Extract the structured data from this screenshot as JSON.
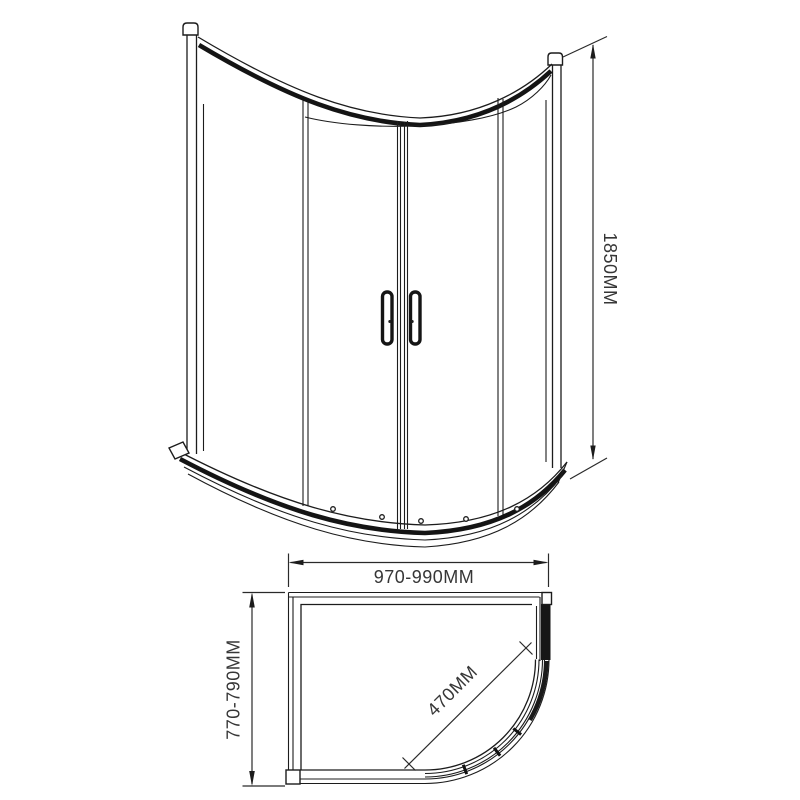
{
  "colors": {
    "background": "#ffffff",
    "line": "#1c1c1c",
    "dimension_text": "#363636",
    "profile_fill": "#161616"
  },
  "views": {
    "front_elevation": {
      "height_dimension_label": "1850MM"
    },
    "plan": {
      "width_dimension_label": "970-990MM",
      "depth_dimension_label": "770-790MM",
      "door_opening_dimension_label": "470MM"
    }
  }
}
